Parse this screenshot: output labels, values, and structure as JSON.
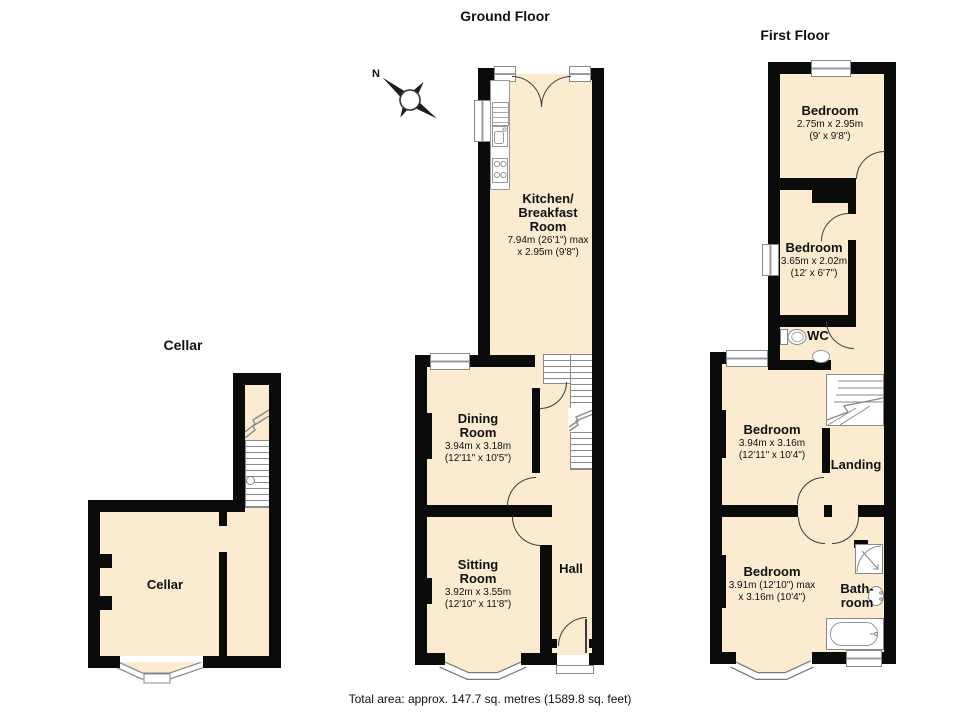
{
  "titles": {
    "cellar": "Cellar",
    "ground_floor": "Ground Floor",
    "first_floor": "First Floor"
  },
  "compass": {
    "north_label": "N"
  },
  "rooms": {
    "cellar": {
      "name": "Cellar"
    },
    "kitchen": {
      "name": "Kitchen/\nBreakfast\nRoom",
      "dims": "7.94m (26'1\") max\nx 2.95m (9'8\")"
    },
    "dining_room": {
      "name": "Dining\nRoom",
      "dims": "3.94m x 3.18m\n(12'11\" x 10'5\")"
    },
    "sitting_room": {
      "name": "Sitting\nRoom",
      "dims": "3.92m x 3.55m\n(12'10\" x 11'8\")"
    },
    "hall": {
      "name": "Hall"
    },
    "bedroom1": {
      "name": "Bedroom",
      "dims": "2.75m x 2.95m\n(9' x 9'8\")"
    },
    "bedroom2": {
      "name": "Bedroom",
      "dims": "3.65m x 2.02m\n(12' x 6'7\")"
    },
    "wc": {
      "name": "WC"
    },
    "bedroom3": {
      "name": "Bedroom",
      "dims": "3.94m x 3.16m\n(12'11\" x 10'4\")"
    },
    "landing": {
      "name": "Landing"
    },
    "bedroom4": {
      "name": "Bedroom",
      "dims": "3.91m (12'10\") max\nx 3.16m (10'4\")"
    },
    "bathroom": {
      "name": "Bath-\nroom"
    }
  },
  "footer": {
    "total_area": "Total area: approx. 147.7 sq. metres (1589.8 sq. feet)"
  },
  "colors": {
    "room_fill": "#FAEBD1",
    "wall": "#0B0B0B",
    "fixture_line": "#8A8A8A",
    "door_line": "#3C3C3C"
  }
}
